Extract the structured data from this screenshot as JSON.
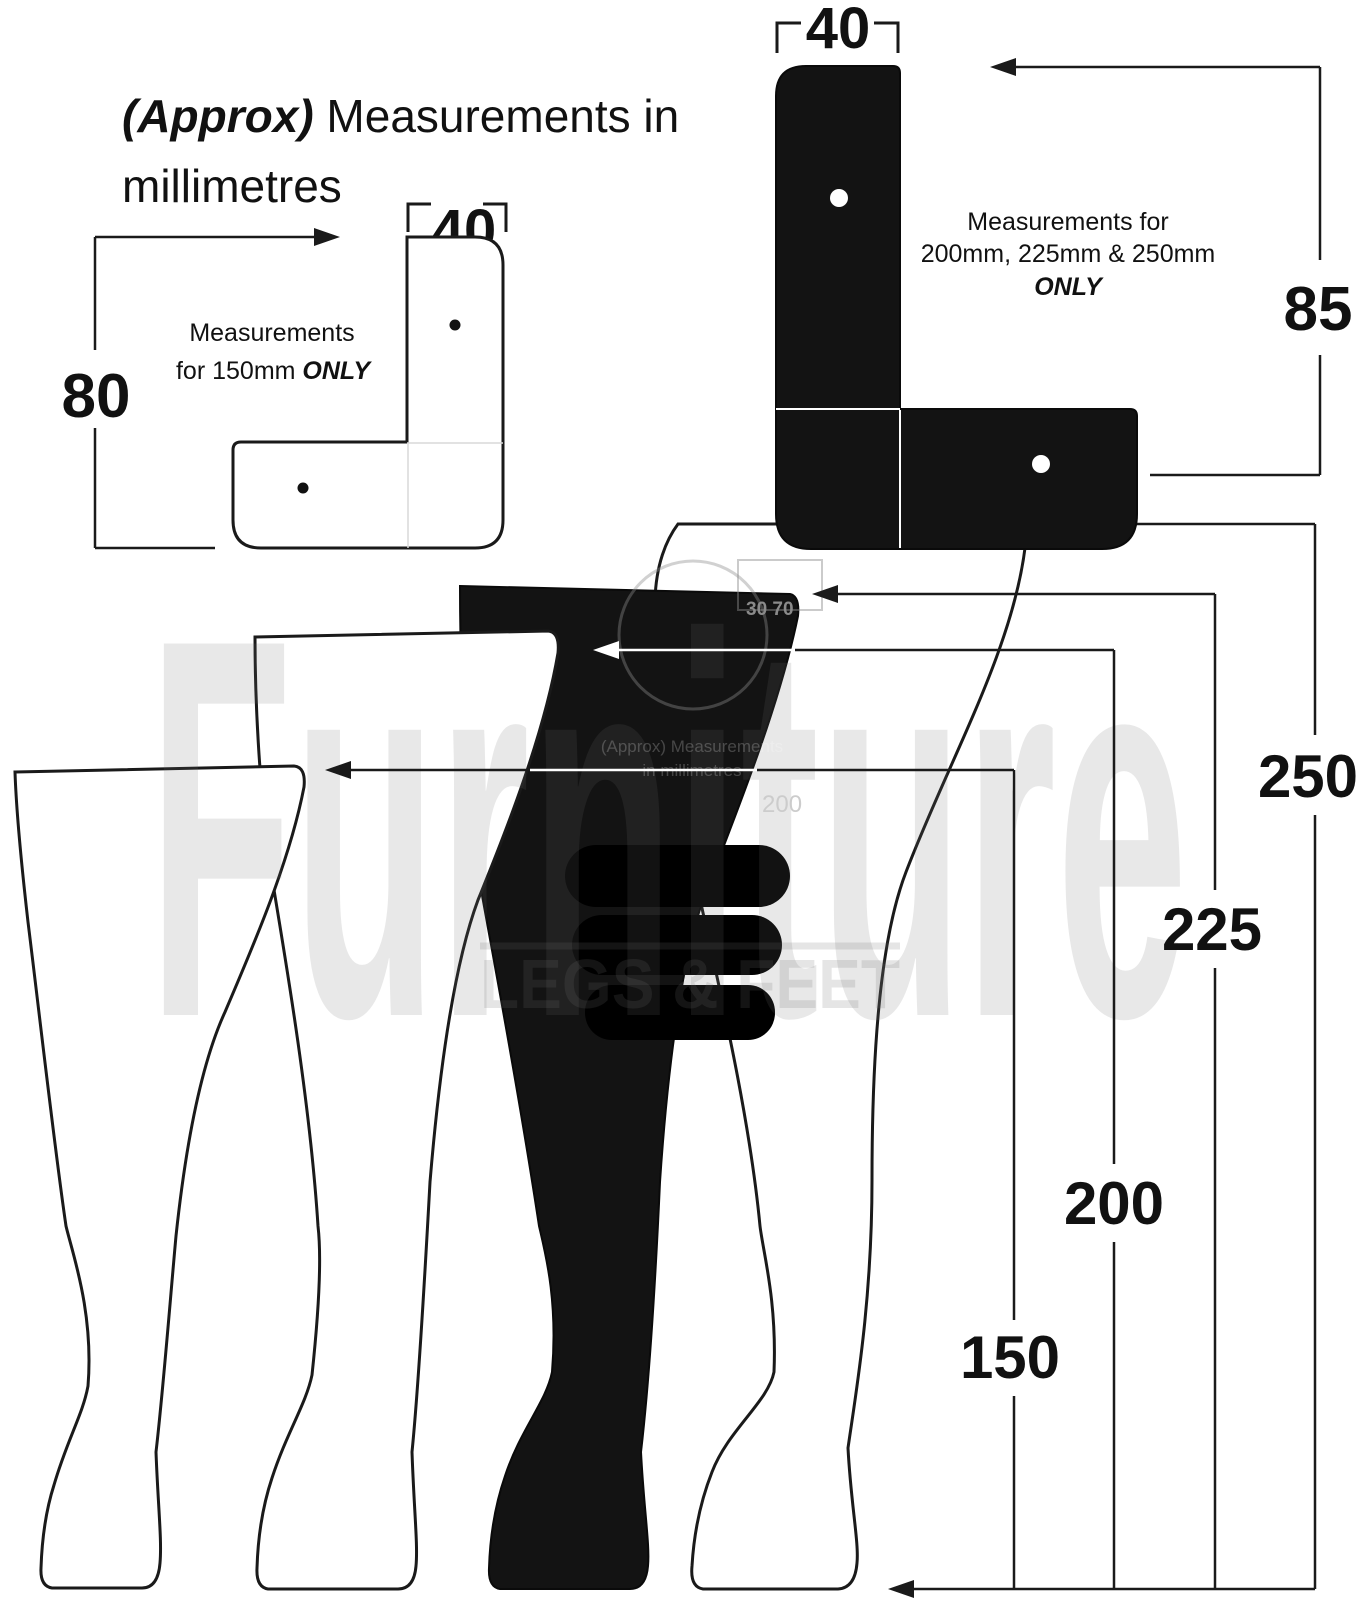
{
  "header": {
    "approx": "(Approx)",
    "rest": " Measurements in",
    "line2": "millimetres"
  },
  "bracket_150": {
    "width_label": "40",
    "height_label": "80",
    "note_line1": "Measurements",
    "note_line2": "for 150mm ",
    "note_only": "ONLY"
  },
  "bracket_large": {
    "width_label": "40",
    "height_label": "85",
    "note_line1": "Measurements for",
    "note_line2": "200mm, 225mm & 250mm",
    "note_only": "ONLY"
  },
  "legs": {
    "unit": "mm",
    "sizes": [
      {
        "label": "250"
      },
      {
        "label": "225"
      },
      {
        "label": "200"
      },
      {
        "label": "150"
      }
    ]
  },
  "watermark": {
    "brand": "Furniture",
    "sub": "LEGS & FEET"
  },
  "ghost": {
    "dim": "30 70",
    "approx_line1": "(Approx) Measurements",
    "approx_line2": "in millimetres",
    "size": "200"
  },
  "colors": {
    "ink": "#1a1a1a",
    "leg_black": "#131313",
    "watermark_gray": "#e9e9e9"
  }
}
